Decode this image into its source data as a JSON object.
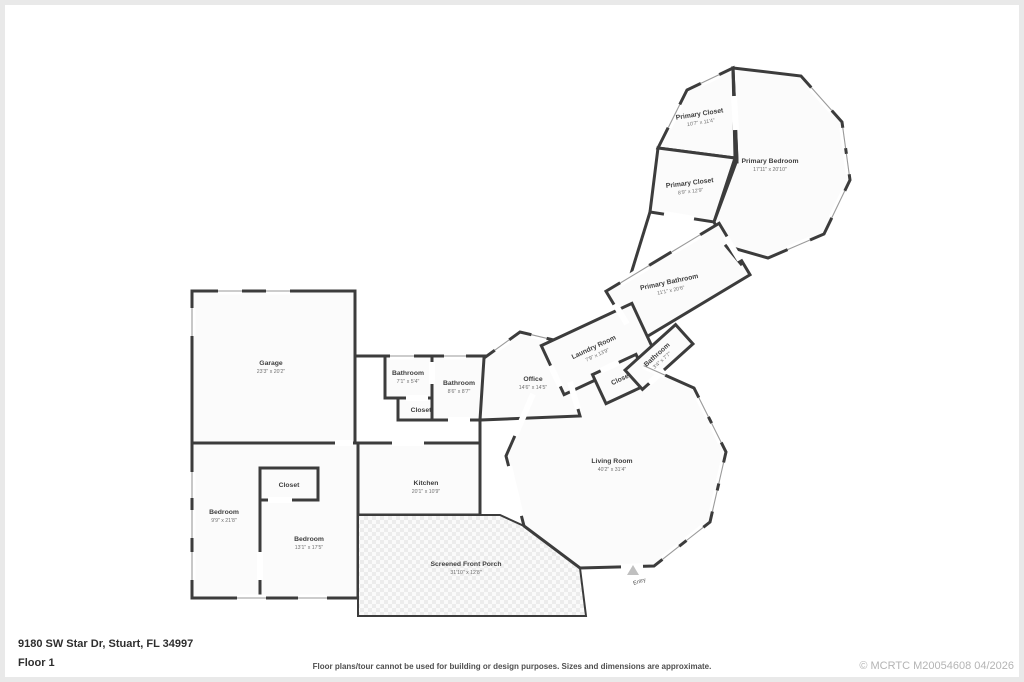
{
  "footer": {
    "address": "9180 SW Star Dr, Stuart, FL 34997",
    "floor_label": "Floor 1",
    "disclaimer": "Floor plans/tour cannot be used for building or design purposes. Sizes and dimensions are approximate.",
    "copyright": "© MCRTC M20054608 04/2026"
  },
  "colors": {
    "wall": "#3c3c3c",
    "room_fill": "#fbfbfb",
    "window": "#9a9a9a",
    "label_text": "#3f3f3f",
    "dim_text": "#707070",
    "copyright_text": "#b4b4b4",
    "porch_hatch": "#ececec"
  },
  "entry": {
    "label": "Entry"
  },
  "rooms": [
    {
      "name": "Garage",
      "dims": "23'3\" x 20'2\""
    },
    {
      "name": "Bathroom",
      "dims": "7'1\" x 5'4\""
    },
    {
      "name": "Closet",
      "dims": ""
    },
    {
      "name": "Bathroom",
      "dims": "8'6\" x 8'7\""
    },
    {
      "name": "Office",
      "dims": "14'6\" x 14'5\""
    },
    {
      "name": "Laundry Room",
      "dims": "7'9\" x 13'9\""
    },
    {
      "name": "Closet",
      "dims": ""
    },
    {
      "name": "Bathroom",
      "dims": "3'4\" x 7'7\""
    },
    {
      "name": "Primary Bathroom",
      "dims": "11'1\" x 20'6\""
    },
    {
      "name": "Primary Closet",
      "dims": "10'7\" x 11'4\""
    },
    {
      "name": "Primary Bedroom",
      "dims": "17'11\" x 20'10\""
    },
    {
      "name": "Primary Closet",
      "dims": "8'9\" x 12'9\""
    },
    {
      "name": "Bedroom",
      "dims": "9'9\" x 21'8\""
    },
    {
      "name": "Closet",
      "dims": ""
    },
    {
      "name": "Bedroom",
      "dims": "13'1\" x 17'5\""
    },
    {
      "name": "Kitchen",
      "dims": "20'1\" x 10'9\""
    },
    {
      "name": "Living Room",
      "dims": "40'2\" x 31'4\""
    },
    {
      "name": "Screened Front Porch",
      "dims": "31'10\" x 12'8\""
    }
  ]
}
